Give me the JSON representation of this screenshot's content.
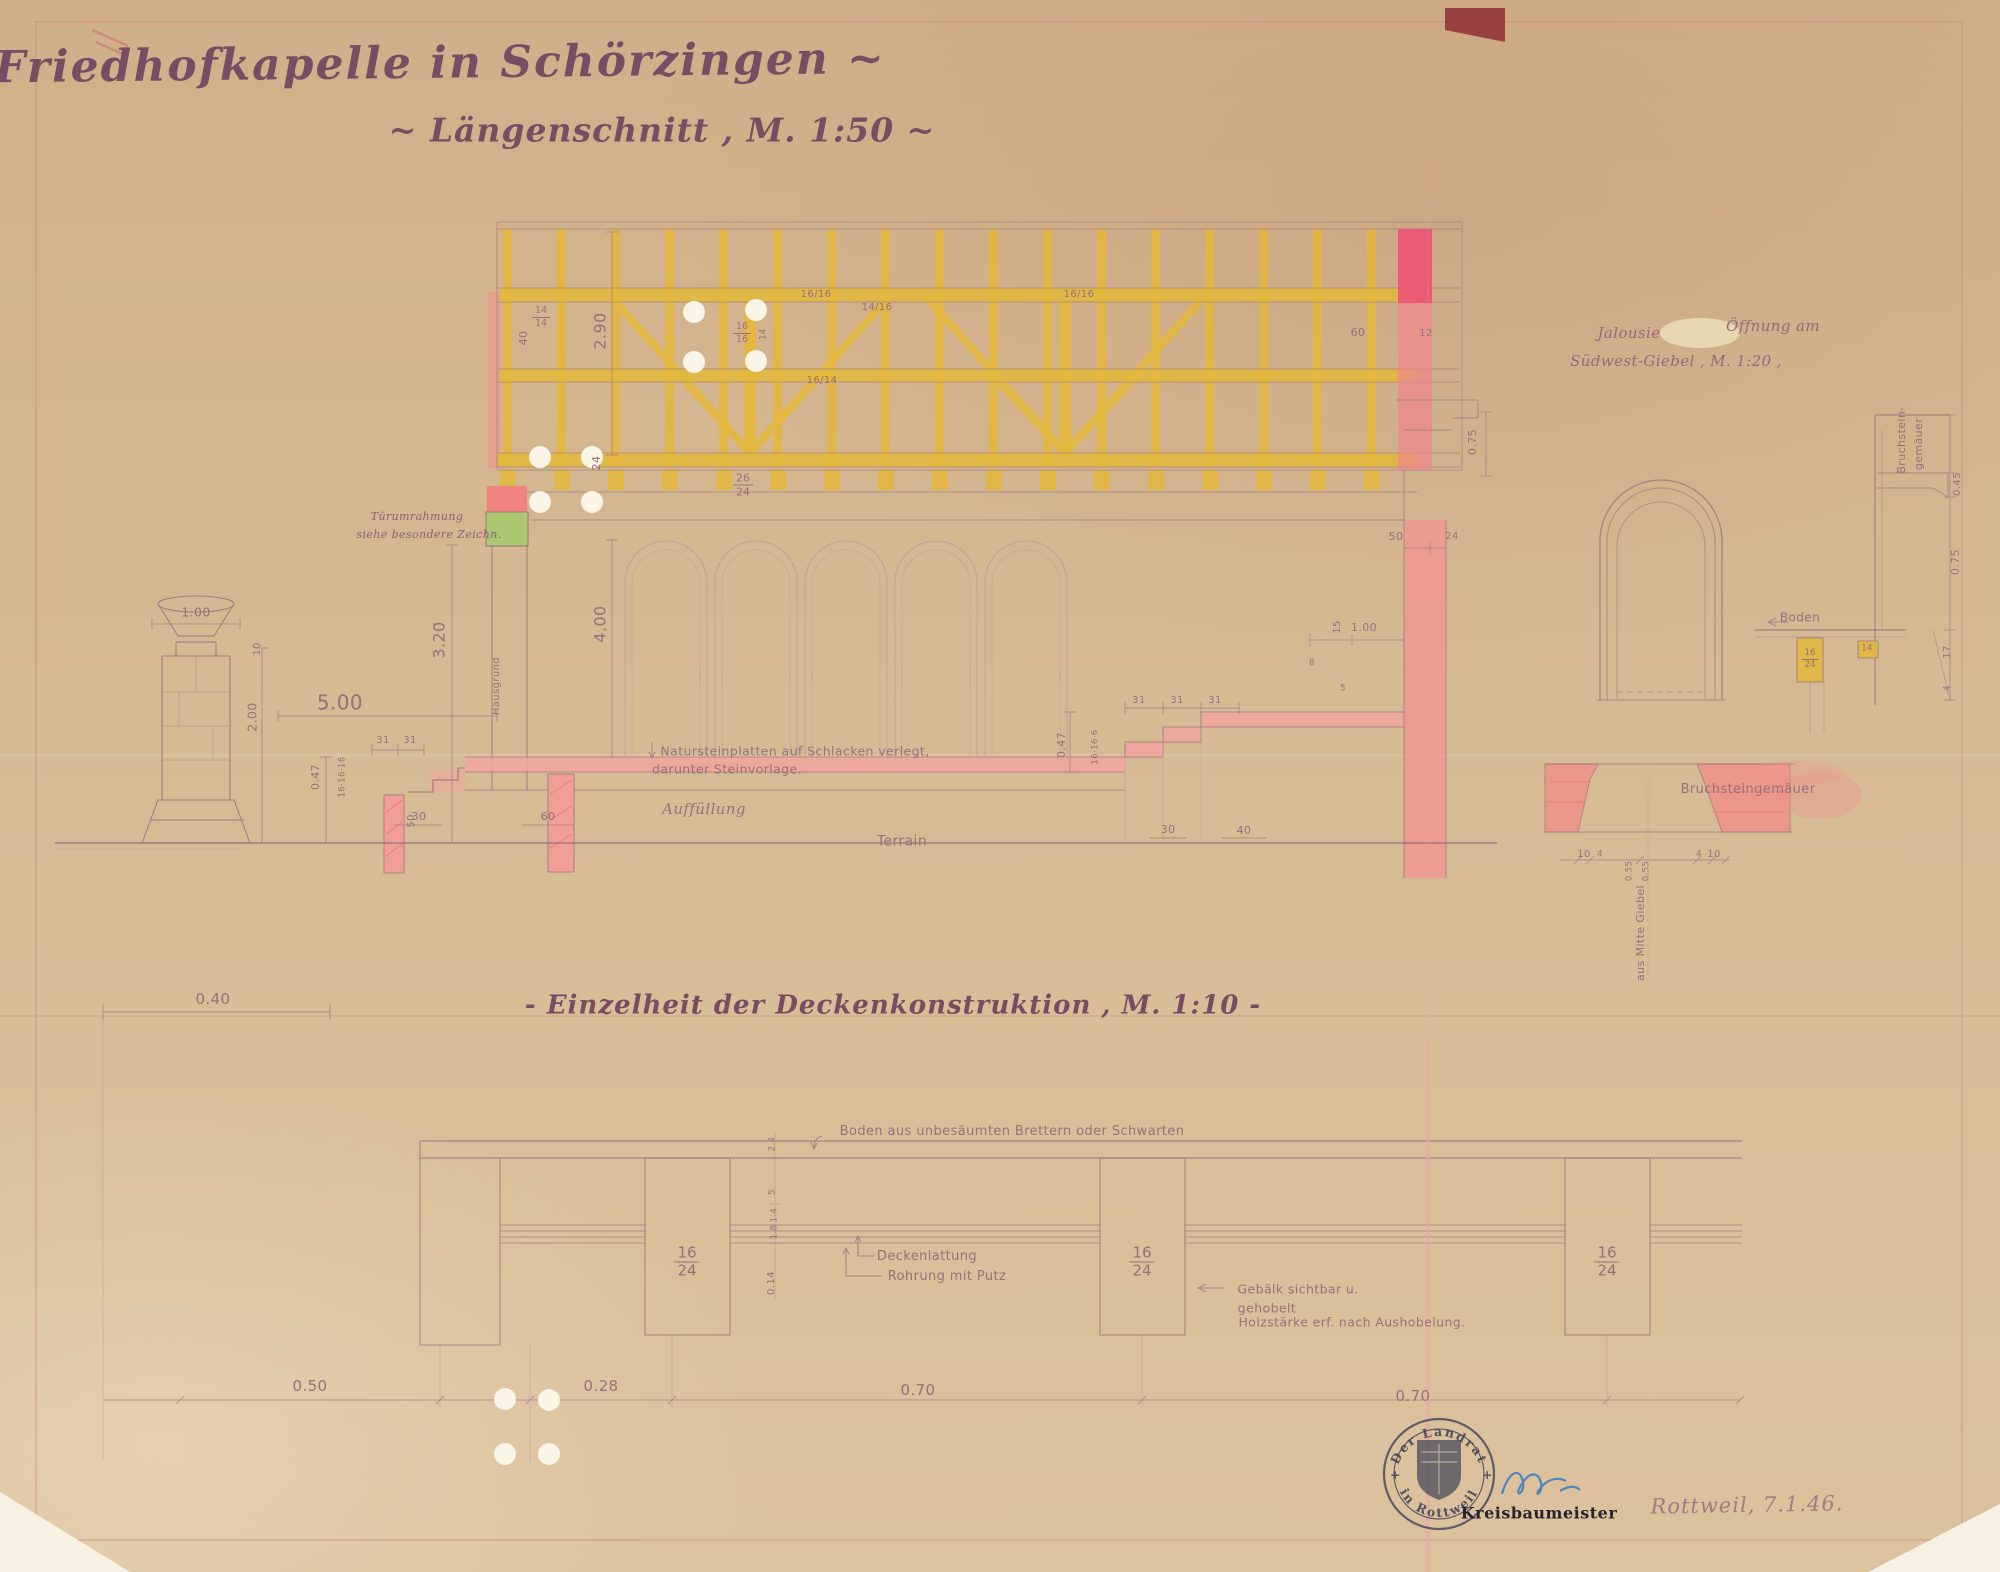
{
  "titles": {
    "main": "~ Friedhofkapelle in Schörzingen ~",
    "section": "~ Längenschnitt , M. 1:50 ~",
    "detail": "- Einzelheit der Deckenkonstruktion , M. 1:10 -"
  },
  "jalousie_note": {
    "word1": "Jalousie",
    "word2": "Öffnung am",
    "line2": "Südwest-Giebel , M. 1:20 ,"
  },
  "annotations": {
    "tuer1": "Türumrahmung",
    "tuer2": "siehe besondere Zeichn.",
    "naturstein1": "Natursteinplatten auf Schlacken verlegt,",
    "naturstein2": "darunter Steinvorlage.",
    "auffuellung": "Auffüllung",
    "terrain": "Terrain",
    "hausgrund": "Hausgrund",
    "bruchstein1": "Bruchstein-",
    "bruchstein2": "gemäuer",
    "boden": "Boden",
    "bruchsteingemaeuer": "Bruchsteingemäuer",
    "ausmitte": "aus Mitte Giebel",
    "boden_detail": "Boden aus unbesäumten Brettern oder Schwarten",
    "deckenlattung": "Deckenlattung",
    "rohrung": "Rohrung mit Putz",
    "gebaelk1": "Gebälk sichtbar u.",
    "gebaelk2": "gehobelt",
    "gebaelk3": "Holzstärke erf. nach Aushobelung."
  },
  "dims": {
    "d040": "0.40",
    "d050": "0.50",
    "d028": "0.28",
    "d070": "0.70",
    "d100": "1.00",
    "d200": "2.00",
    "d500": "5.00",
    "d320": "3.20",
    "d400": "4.00",
    "d290": "2.90",
    "d047": "0.47",
    "d075": "0.75",
    "d055": "0.55",
    "d045": "0.45",
    "d014": "0.14",
    "d24c": "2.4",
    "d14c": "1.4",
    "d18c": "1.8",
    "d5": "5",
    "d4": "4",
    "d8": "8",
    "d10": "10",
    "d12": "12",
    "d14": "14",
    "d15": "15",
    "d17": "17",
    "d24": "24",
    "d30": "30",
    "d31": "31",
    "d40": "40",
    "d50": "50",
    "d60": "60",
    "f1616": "16/16",
    "f1416": "14/16",
    "f1614": "16/14",
    "r161616": "16·16·16",
    "r16166": "16·16·6"
  },
  "fracs": {
    "f1414": {
      "n": "14",
      "d": "14"
    },
    "f1616": {
      "n": "16",
      "d": "16"
    },
    "f2624": {
      "n": "26",
      "d": "24"
    },
    "beam": {
      "n": "16",
      "d": "24"
    }
  },
  "stamp": {
    "ring_top": "Der Landrat",
    "ring_bottom": "in Rottweil",
    "star": "+",
    "office": "Kreisbaumeister",
    "date_note": "Rottweil, 7.1.46."
  },
  "colors": {
    "paper": "#d5b994",
    "ink": "#7a4c63",
    "pencil": "#9b757c",
    "timber": "#e3b83b",
    "wall_pink": "#f2968e",
    "accent_pink": "#ef5278",
    "door_green": "#a9c870",
    "stamp_blue": "#3e4257",
    "signature_blue": "#3f7fc0"
  }
}
